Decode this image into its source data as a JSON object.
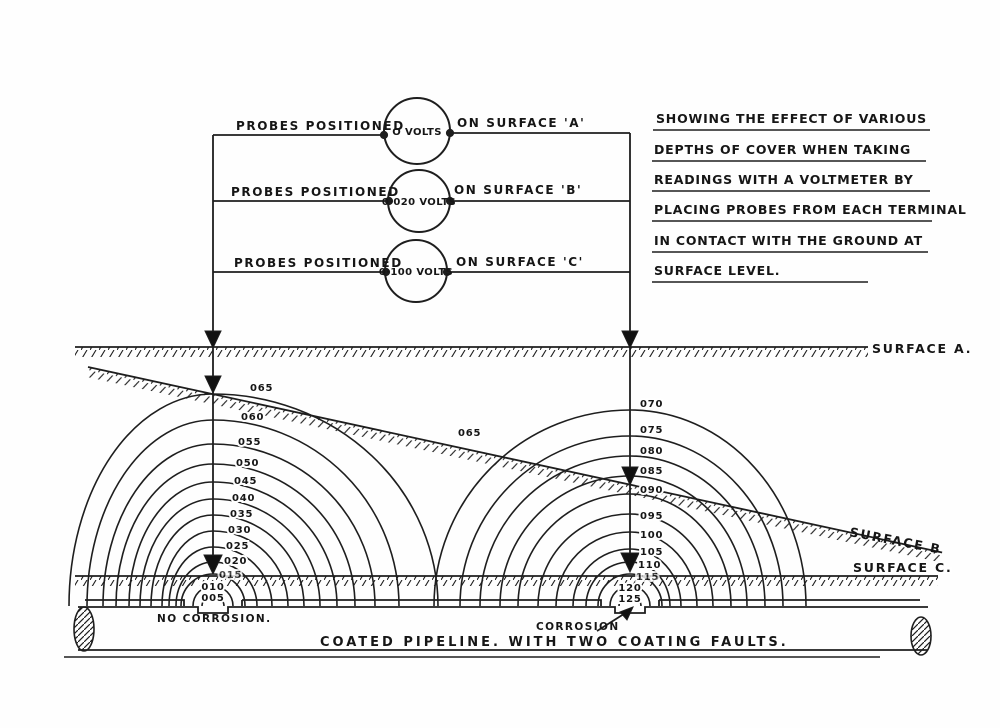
{
  "description_block": {
    "lines": [
      "SHOWING THE EFFECT OF VARIOUS",
      "DEPTHS OF COVER WHEN TAKING",
      "READINGS WITH A VOLTMETER BY",
      "PLACING PROBES FROM EACH TERMINAL",
      "IN CONTACT WITH THE GROUND AT",
      "SURFACE LEVEL."
    ]
  },
  "circuit": {
    "rows": [
      {
        "left_label": "PROBES POSITIONED",
        "meter_reading": "O VOLTS",
        "right_label": "ON SURFACE 'A'"
      },
      {
        "left_label": "PROBES POSITIONED",
        "meter_reading": "0·020 VOLTS",
        "right_label": "ON SURFACE 'B'"
      },
      {
        "left_label": "PROBES POSITIONED",
        "meter_reading": "0·100 VOLTS",
        "right_label": "ON SURFACE 'C'"
      }
    ]
  },
  "surfaces": {
    "a_label": "SURFACE A.",
    "b_label": "SURFACE B",
    "c_label": "SURFACE C."
  },
  "equipotentials": {
    "left_fault": {
      "labels": [
        "065",
        "060",
        "055",
        "050",
        "045",
        "040",
        "035",
        "030",
        "025",
        "020",
        "015",
        "010",
        "005"
      ],
      "note": "NO CORROSION."
    },
    "right_fault": {
      "labels": [
        "070",
        "075",
        "080",
        "085",
        "090",
        "095",
        "100",
        "105",
        "110",
        "115",
        "120",
        "125"
      ],
      "note": "CORROSION"
    },
    "surface_b_crossing_label": "065"
  },
  "pipeline": {
    "caption": "COATED PIPELINE. WITH TWO COATING FAULTS."
  },
  "ink_color": "#1e1e1e"
}
